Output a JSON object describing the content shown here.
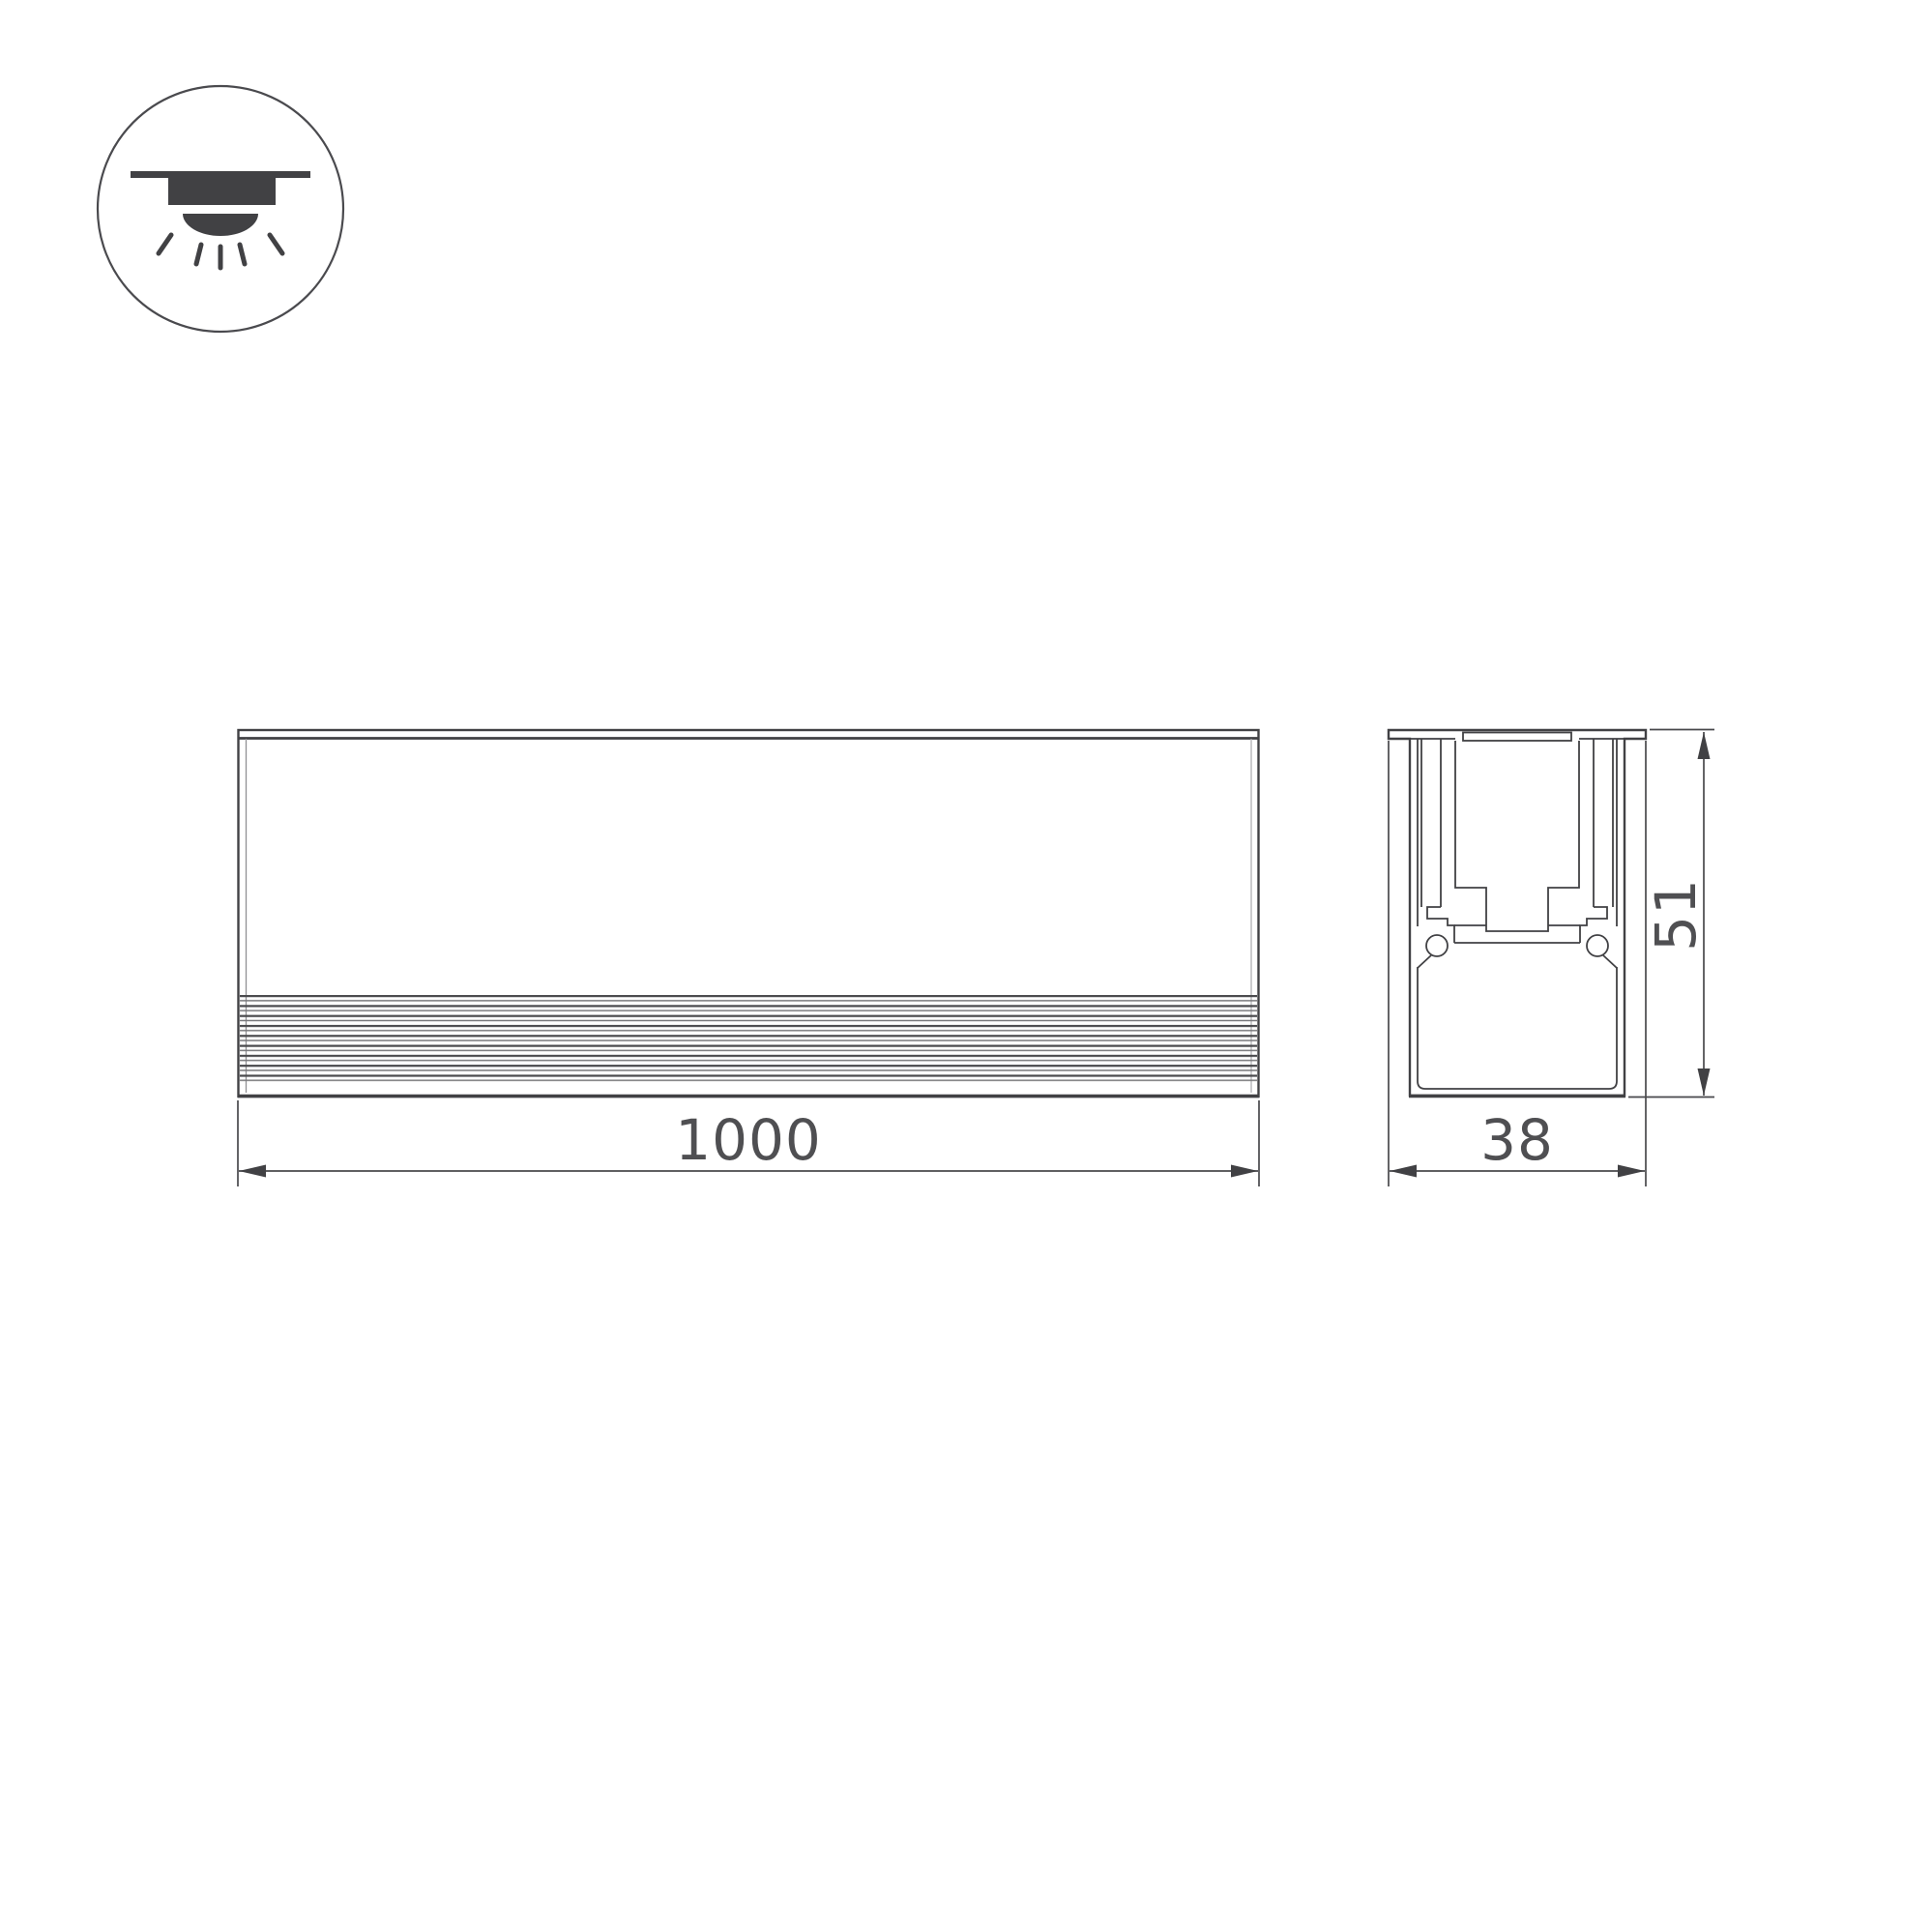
{
  "drawing": {
    "dimensions": {
      "length": "1000",
      "width": "38",
      "height": "51"
    }
  },
  "icon": {
    "name": "recessed-downlight-icon"
  },
  "colors": {
    "line": "#414144",
    "dimension_line": "#49494c",
    "text": "#4f4f52",
    "background": "#ffffff"
  }
}
